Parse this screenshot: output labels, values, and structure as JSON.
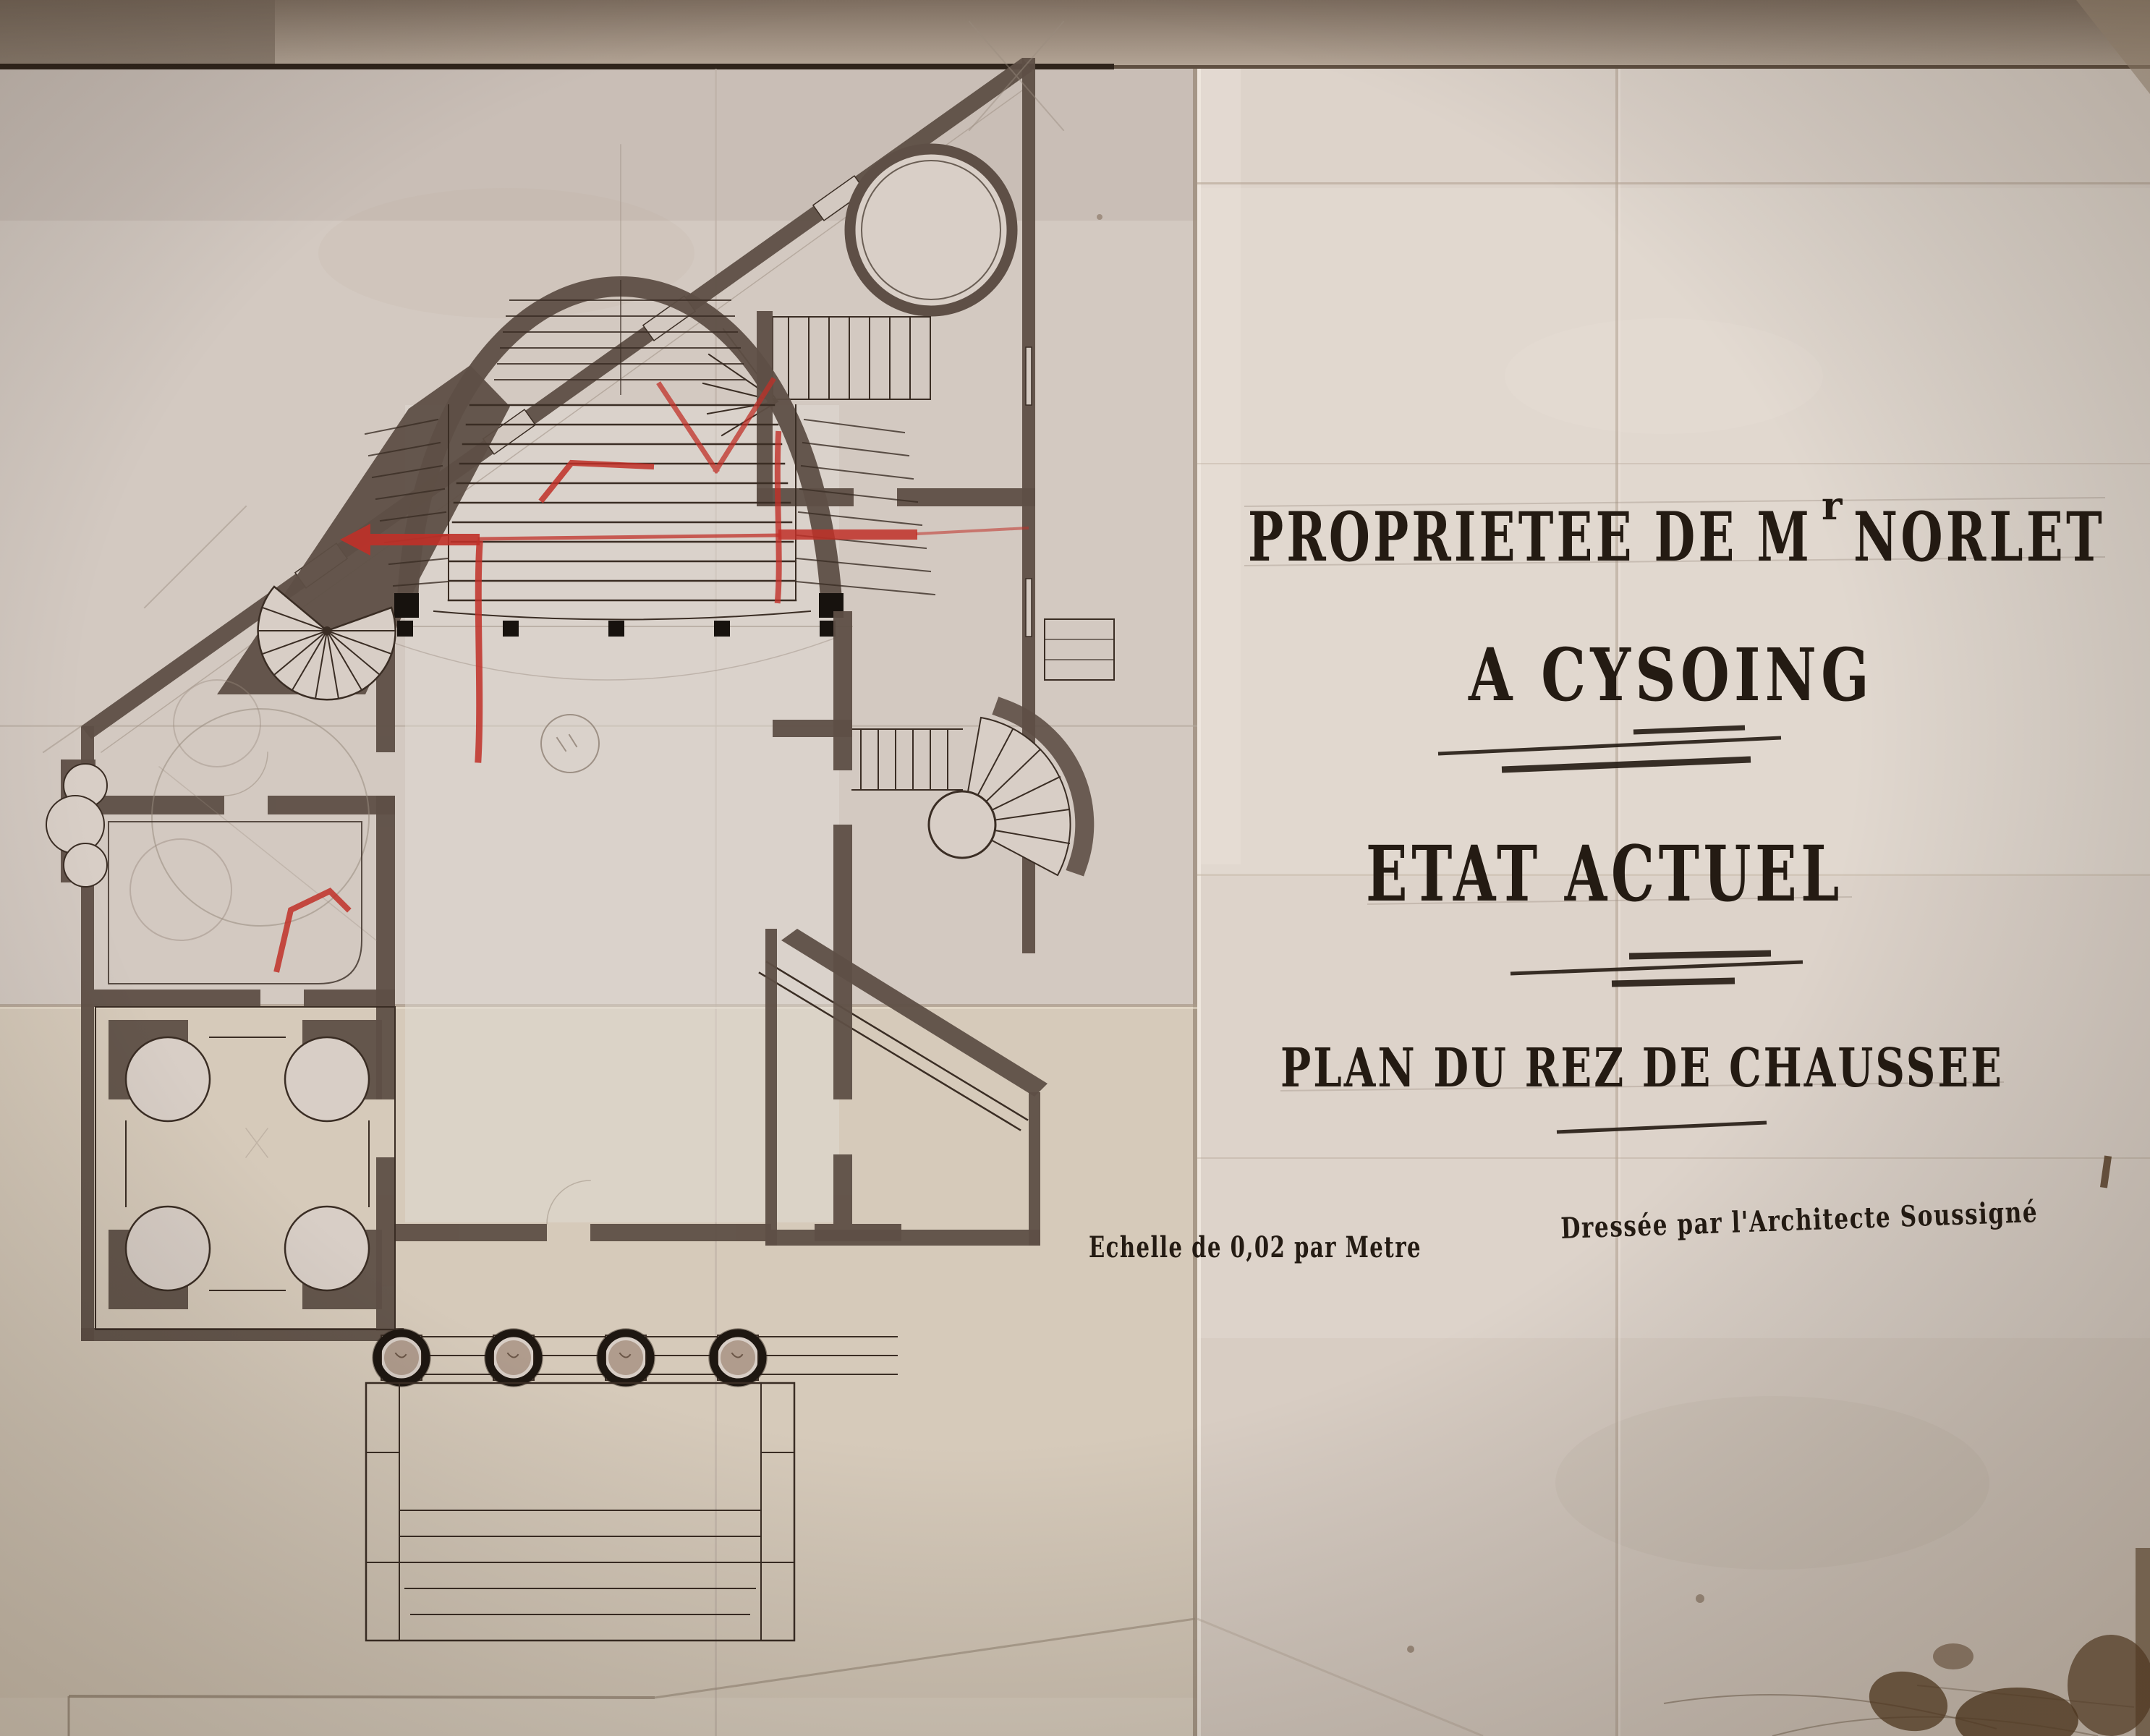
{
  "sheet": {
    "title_main": "PROPRIETEE DE M",
    "title_sup": "r",
    "title_tail": "NORLET",
    "location_line": "A CYSOING",
    "state_line": "ETAT ACTUEL",
    "subtitle_line": "PLAN DU REZ DE CHAUSSEE",
    "scale_note": "Echelle de 0,02 par Metre",
    "credit_note": "Dressée par l'Architecte Soussigné"
  },
  "drawing": {
    "kind": "ground floor architectural plan, état actuel",
    "column_count": 4,
    "correction_color_note": "red pencil revision marks on grand staircase"
  },
  "colors": {
    "paper_left": "#d3c9c1",
    "paper_right": "#ddd3ca",
    "paper_warm": "#d8cab5",
    "top_band": "#8d7d6f",
    "ink": "#3a2d24",
    "lettering_ink": "#241b13",
    "poche_wall": "#5e4f46",
    "pencil": "#998b7e",
    "red_correction": "#c03028",
    "stain": "#53381f"
  }
}
